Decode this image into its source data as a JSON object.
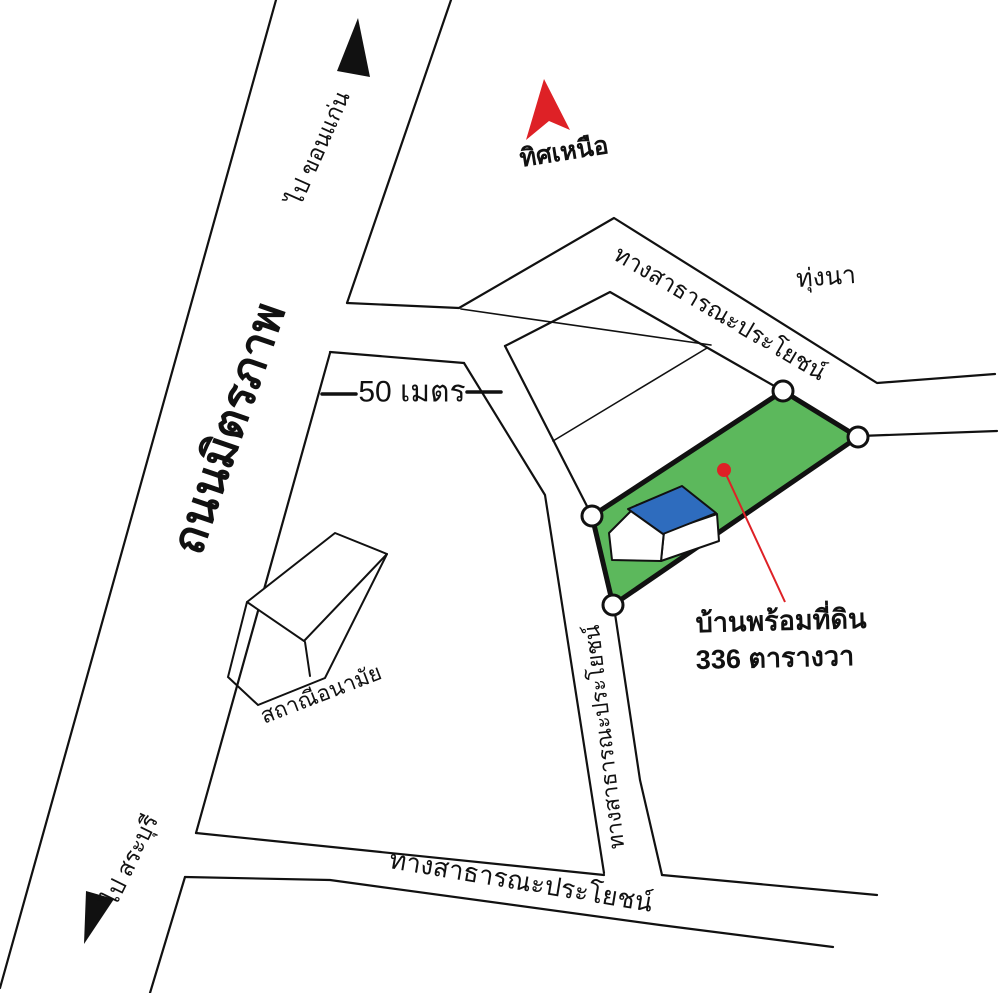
{
  "compass": {
    "north_label": "ทิศเหนือ"
  },
  "roads": {
    "highway_name": "ถนนมิตรภาพ",
    "to_khon_kaen": "ไป ขอนแก่น",
    "to_saraburi": "ไป สระบุรี",
    "public_road_ne": "ทางสาธารณะประโยชน์",
    "public_road_soi": "ทางสาธารณะประโยชน์",
    "public_road_south": "ทางสาธารณะประโยชน์"
  },
  "scale": {
    "label": "50 เมตร"
  },
  "places": {
    "rice_field": "ทุ่งนา",
    "health_station": "สถาณีอนามัย"
  },
  "property": {
    "line1": "บ้านพร้อมที่ดิน",
    "line2": "336 ตารางวา"
  },
  "colors": {
    "plot_green": "#5cb85c",
    "roof_blue": "#2e6cbe",
    "accent_red": "#de2126",
    "ink_black": "#111111"
  }
}
